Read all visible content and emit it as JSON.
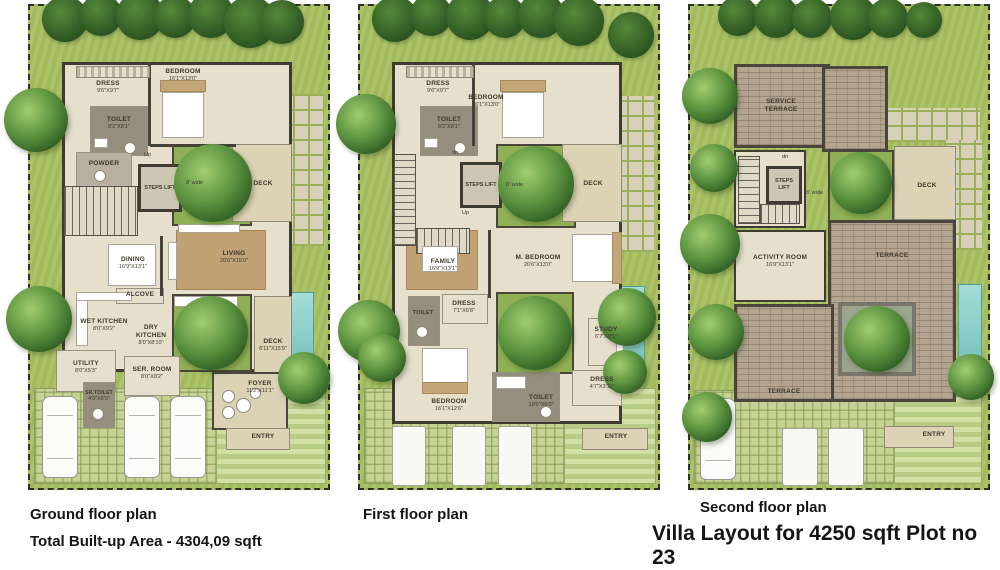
{
  "title": "Villa Layout for 4250 sqft Plot no 23",
  "footer": {
    "total_area": "Total Built-up Area - 4304,09 sqft"
  },
  "colors": {
    "grass": "#a7bf61",
    "wall": "#3e3b33",
    "deck": "#dcd2b6",
    "brick": "#b3a590",
    "pool": "#6fbdb8",
    "floor": "#e6dfcc"
  },
  "plans": [
    {
      "caption": "Ground floor plan",
      "rooms": [
        {
          "name": "DRESS",
          "dims": "9'6\"x9'7\""
        },
        {
          "name": "BEDROOM",
          "dims": "16'1\"x13'0\""
        },
        {
          "name": "TOILET",
          "dims": "8'2\"x8'1\""
        },
        {
          "name": "POWDER",
          "dims": ""
        },
        {
          "name": "STEPS LIFT",
          "dims": ""
        },
        {
          "name": "DECK",
          "dims": ""
        },
        {
          "name": "DINING",
          "dims": "16'9\"x13'1\""
        },
        {
          "name": "LIVING",
          "dims": "20'6\"x15'0\""
        },
        {
          "name": "ALCOVE",
          "dims": ""
        },
        {
          "name": "WET KITCHEN",
          "dims": "8'0\"x9'2\""
        },
        {
          "name": "DRY KITCHEN",
          "dims": "8'0\"x8'10\""
        },
        {
          "name": "DECK",
          "dims": "6'11\"x15'9\""
        },
        {
          "name": "UTILITY",
          "dims": "8'0\"x5'3\""
        },
        {
          "name": "SER. ROOM",
          "dims": "8'0\"x8'2\""
        },
        {
          "name": "SR.TOILET",
          "dims": "4'0\"x6'0\""
        },
        {
          "name": "FOYER",
          "dims": "11'2\"x11'1\""
        },
        {
          "name": "ENTRY",
          "dims": ""
        }
      ],
      "annotations": [
        "8' wide",
        "Up"
      ]
    },
    {
      "caption": "First floor plan",
      "rooms": [
        {
          "name": "DRESS",
          "dims": "9'6\"x9'7\""
        },
        {
          "name": "BEDROOM",
          "dims": "16'1\"x13'0\""
        },
        {
          "name": "TOILET",
          "dims": "8'2\"x8'1\""
        },
        {
          "name": "STEPS LIFT",
          "dims": ""
        },
        {
          "name": "DECK",
          "dims": ""
        },
        {
          "name": "FAMILY",
          "dims": "16'9\"x13'1\""
        },
        {
          "name": "M. BEDROOM",
          "dims": "20'6\"x13'0\""
        },
        {
          "name": "DRESS",
          "dims": "7'1\"x6'8\""
        },
        {
          "name": "TOILET",
          "dims": ""
        },
        {
          "name": "STUDY",
          "dims": "6'7\"x9'5\""
        },
        {
          "name": "BEDROOM",
          "dims": "16'1\"x12'6\""
        },
        {
          "name": "TOILET",
          "dims": "10'0\"x6'0\""
        },
        {
          "name": "DRESS",
          "dims": "4'7\"x3'11\""
        },
        {
          "name": "ENTRY",
          "dims": ""
        }
      ],
      "annotations": [
        "8' wide",
        "Up",
        "dn"
      ]
    },
    {
      "caption": "Second floor plan",
      "rooms": [
        {
          "name": "SERVICE TERRACE",
          "dims": ""
        },
        {
          "name": "STEPS LIFT",
          "dims": ""
        },
        {
          "name": "DECK",
          "dims": ""
        },
        {
          "name": "ACTIVITY ROOM",
          "dims": "16'9\"x13'1\""
        },
        {
          "name": "TERRACE",
          "dims": ""
        },
        {
          "name": "TERRACE",
          "dims": ""
        },
        {
          "name": "ENTRY",
          "dims": ""
        }
      ],
      "annotations": [
        "8' wide",
        "dn"
      ]
    }
  ]
}
